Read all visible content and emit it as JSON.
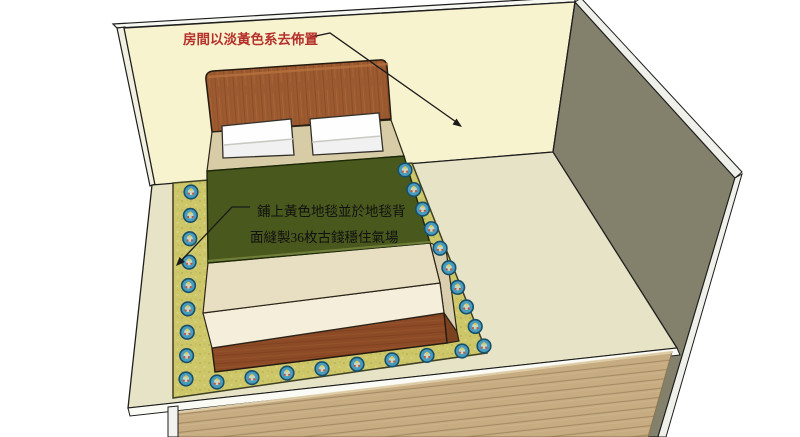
{
  "annotations": {
    "room_note": {
      "text": "房間以淡黃色系去佈置",
      "color": "#b5302a"
    },
    "carpet_note": {
      "line1": "鋪上黃色地毯並於地毯背",
      "line2": "面縫製36枚古錢穩住氣場",
      "color": "#101010"
    }
  },
  "scene": {
    "colors": {
      "background": "#ffffff",
      "wall_back": "#f7f3cf",
      "wall_right": "#83816c",
      "wall_edge": "#f2f0e0",
      "wall_top_edge": "#f8f8f2",
      "floor": "#e7e3c6",
      "floor_edge": "#fbfbf6",
      "carpet": "#cdc76a",
      "blanket": "#49591d",
      "blanket_fold": "#77853e",
      "deck": "#d8cca6",
      "headboard": "#9c5a30",
      "mattress_top": "#e8dfc2",
      "mattress_front": "#f4eedb",
      "mattress_side": "#d9cfae",
      "bed_base": "#8c4a26",
      "bed_base_side": "#7c421f",
      "pillow": "#fefefe",
      "planks": "#c7ac82",
      "corner_post": "#f2f2ee",
      "outline": "#1e1e1e",
      "leader_line": "#1a1a1a"
    },
    "coins": {
      "radius": 6.8,
      "ring": "#17506a",
      "body": "#4a9cbc",
      "center": "#c6d8c2",
      "dot_yellow": "#e2c84e",
      "dot_red": "#c05246",
      "sides": [
        {
          "from": [
            191,
            192
          ],
          "to": [
            186,
            379
          ],
          "count": 9
        },
        {
          "from": [
            217,
            382
          ],
          "to": [
            462,
            351
          ],
          "count": 8
        },
        {
          "from": [
            405,
            170
          ],
          "to": [
            484,
            346
          ],
          "count": 10
        }
      ]
    }
  }
}
